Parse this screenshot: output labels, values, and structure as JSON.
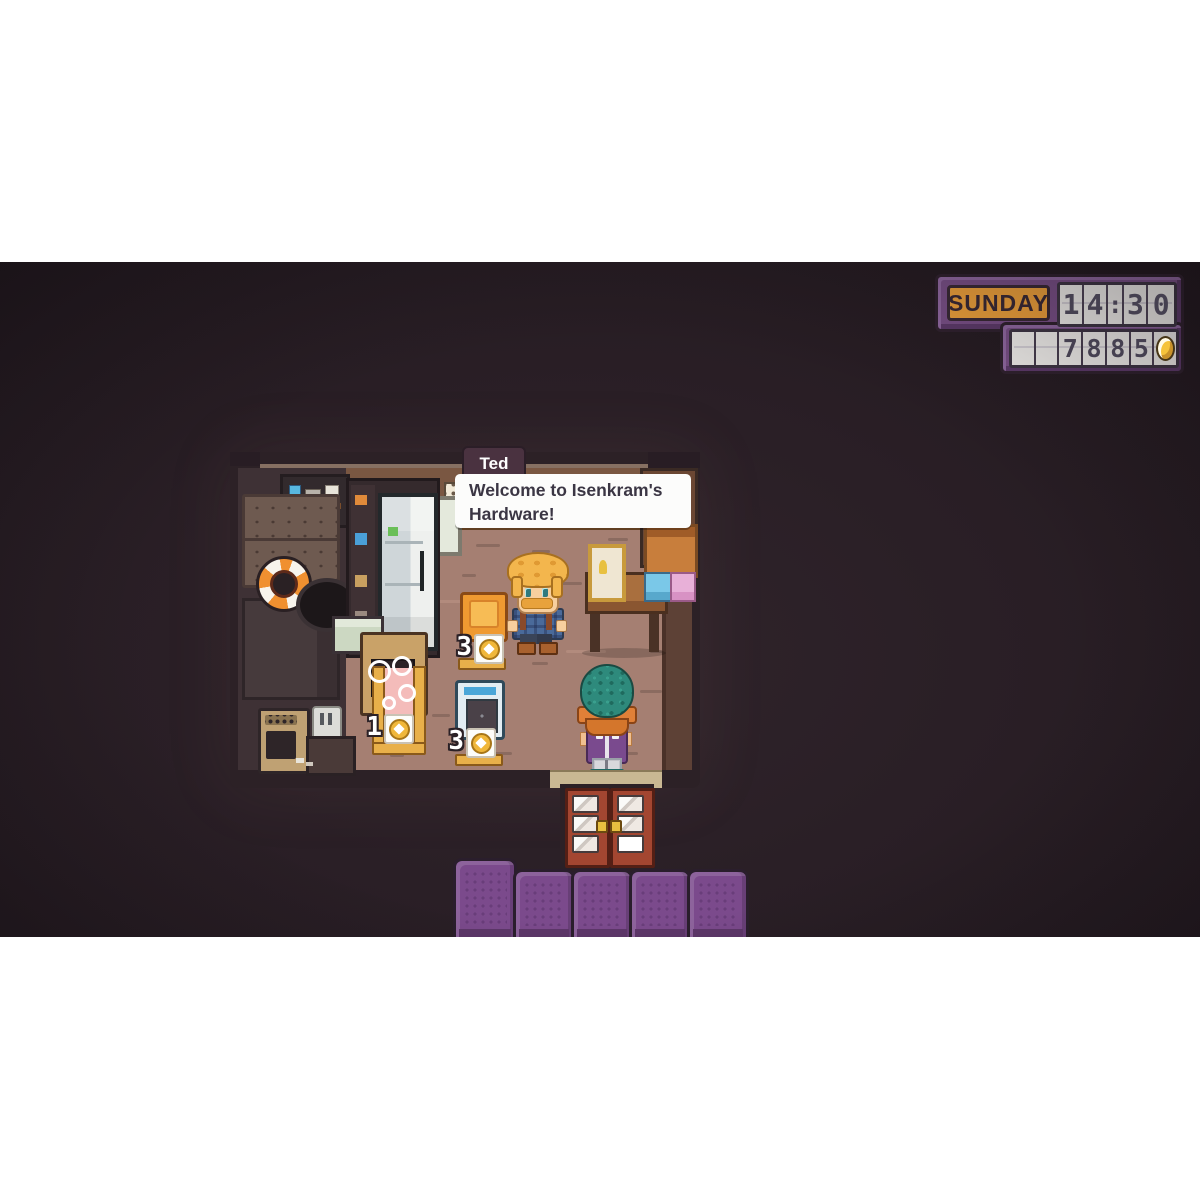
{
  "hud": {
    "day": "SUNDAY",
    "time": "14:30",
    "money": "7885",
    "coin_icon": "coin-icon",
    "colors": {
      "frame_purple": "#7b5189",
      "day_orange": "#f1a33c",
      "panel_white": "#f4f2ef",
      "digit_dark": "#454050",
      "coin_gold": "#f5c33b"
    }
  },
  "dialogue": {
    "speaker": "Ted",
    "text": "Welcome to Isenkram's Hardware!"
  },
  "shop": {
    "items": [
      {
        "id": "orange-heater",
        "price": "3",
        "currency_icon": "coin-icon"
      },
      {
        "id": "pink-bath",
        "price": "1",
        "currency_icon": "coin-icon"
      },
      {
        "id": "blue-washer",
        "price": "3",
        "currency_icon": "coin-icon"
      }
    ]
  },
  "scene": {
    "colors": {
      "background": "#2a1f26",
      "floor": "#a57f72",
      "wall": "#7a5742",
      "room_outline": "#2c2126",
      "roof_tile_purple": "#7b4a8c",
      "door_red": "#a34631",
      "dialogue_tag": "#4a3240"
    }
  }
}
